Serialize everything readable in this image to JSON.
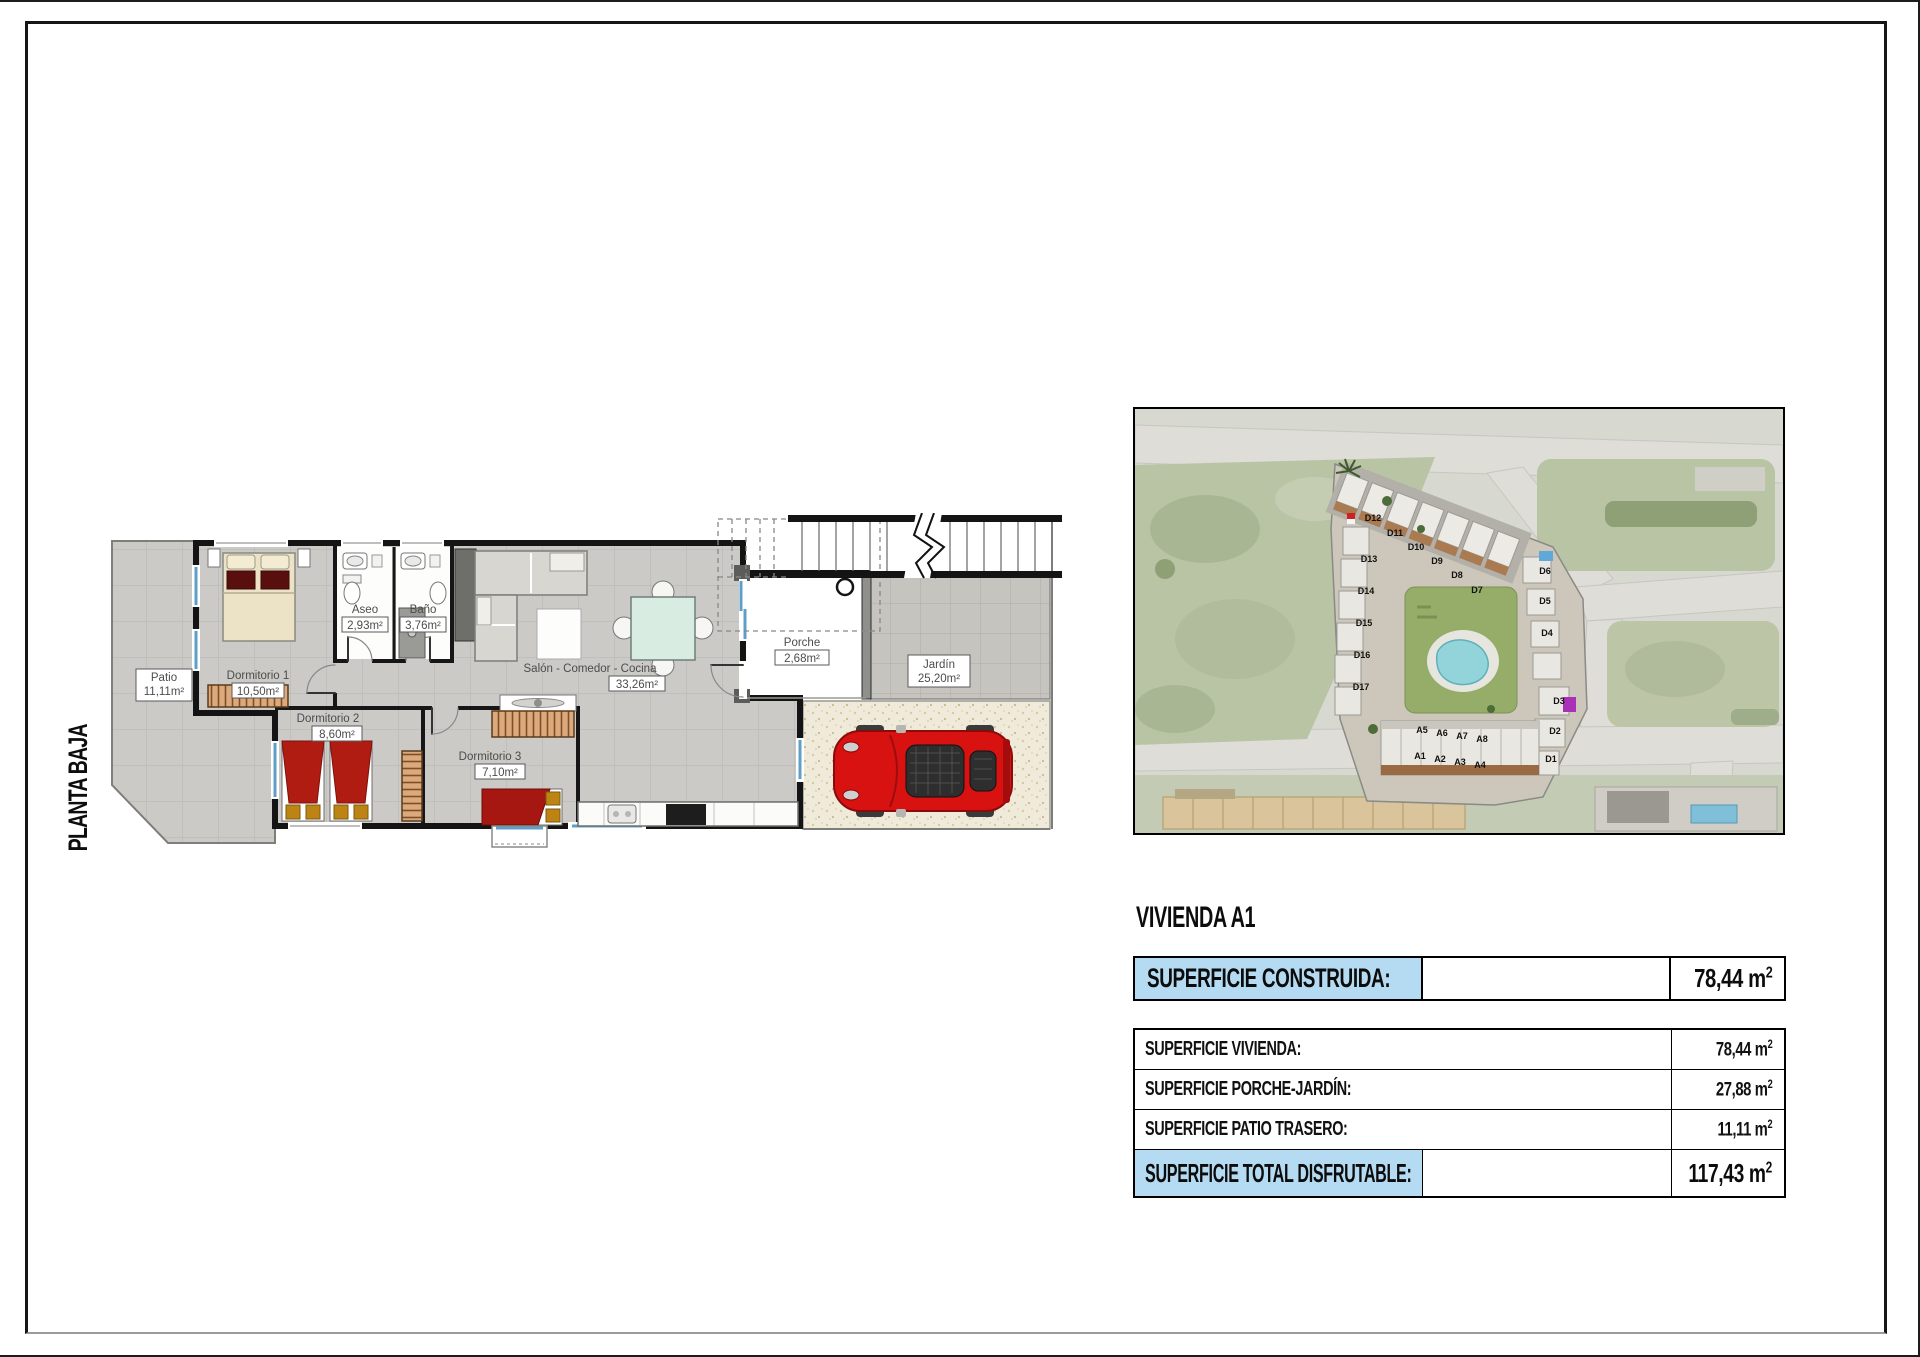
{
  "page": {
    "orientation_label": "PLANTA BAJA"
  },
  "plan": {
    "rooms": [
      {
        "name": "Patio",
        "area": "11,11m²"
      },
      {
        "name": "Dormitorio 1",
        "area": "10,50m²"
      },
      {
        "name": "Aseo",
        "area": "2,93m²"
      },
      {
        "name": "Baño",
        "area": "3,76m²"
      },
      {
        "name": "Salón - Comedor - Cocina",
        "area": "33,26m²"
      },
      {
        "name": "Dormitorio 2",
        "area": "8,60m²"
      },
      {
        "name": "Dormitorio 3",
        "area": "7,10m²"
      },
      {
        "name": "Porche",
        "area": "2,68m²"
      },
      {
        "name": "Jardín",
        "area": "25,20m²"
      }
    ]
  },
  "site_map": {
    "units": [
      "D12",
      "D11",
      "D10",
      "D9",
      "D8",
      "D7",
      "D13",
      "D14",
      "D15",
      "D16",
      "D17",
      "D6",
      "D5",
      "D4",
      "D3",
      "D2",
      "D1",
      "A5",
      "A6",
      "A7",
      "A8",
      "A1",
      "A2",
      "A3",
      "A4"
    ]
  },
  "panel": {
    "title": "VIVIENDA A1",
    "construida": {
      "label": "SUPERFICIE CONSTRUIDA:",
      "value": "78,44 m",
      "sup": "2"
    },
    "rows": [
      {
        "label": "SUPERFICIE VIVIENDA:",
        "value": "78,44 m",
        "sup": "2"
      },
      {
        "label": "SUPERFICIE PORCHE-JARDÍN:",
        "value": "27,88 m",
        "sup": "2"
      },
      {
        "label": "SUPERFICIE PATIO TRASERO:",
        "value": "11,11 m",
        "sup": "2"
      }
    ],
    "total": {
      "label": "SUPERFICIE TOTAL DISFRUTABLE:",
      "value": "117,43 m",
      "sup": "2"
    }
  }
}
